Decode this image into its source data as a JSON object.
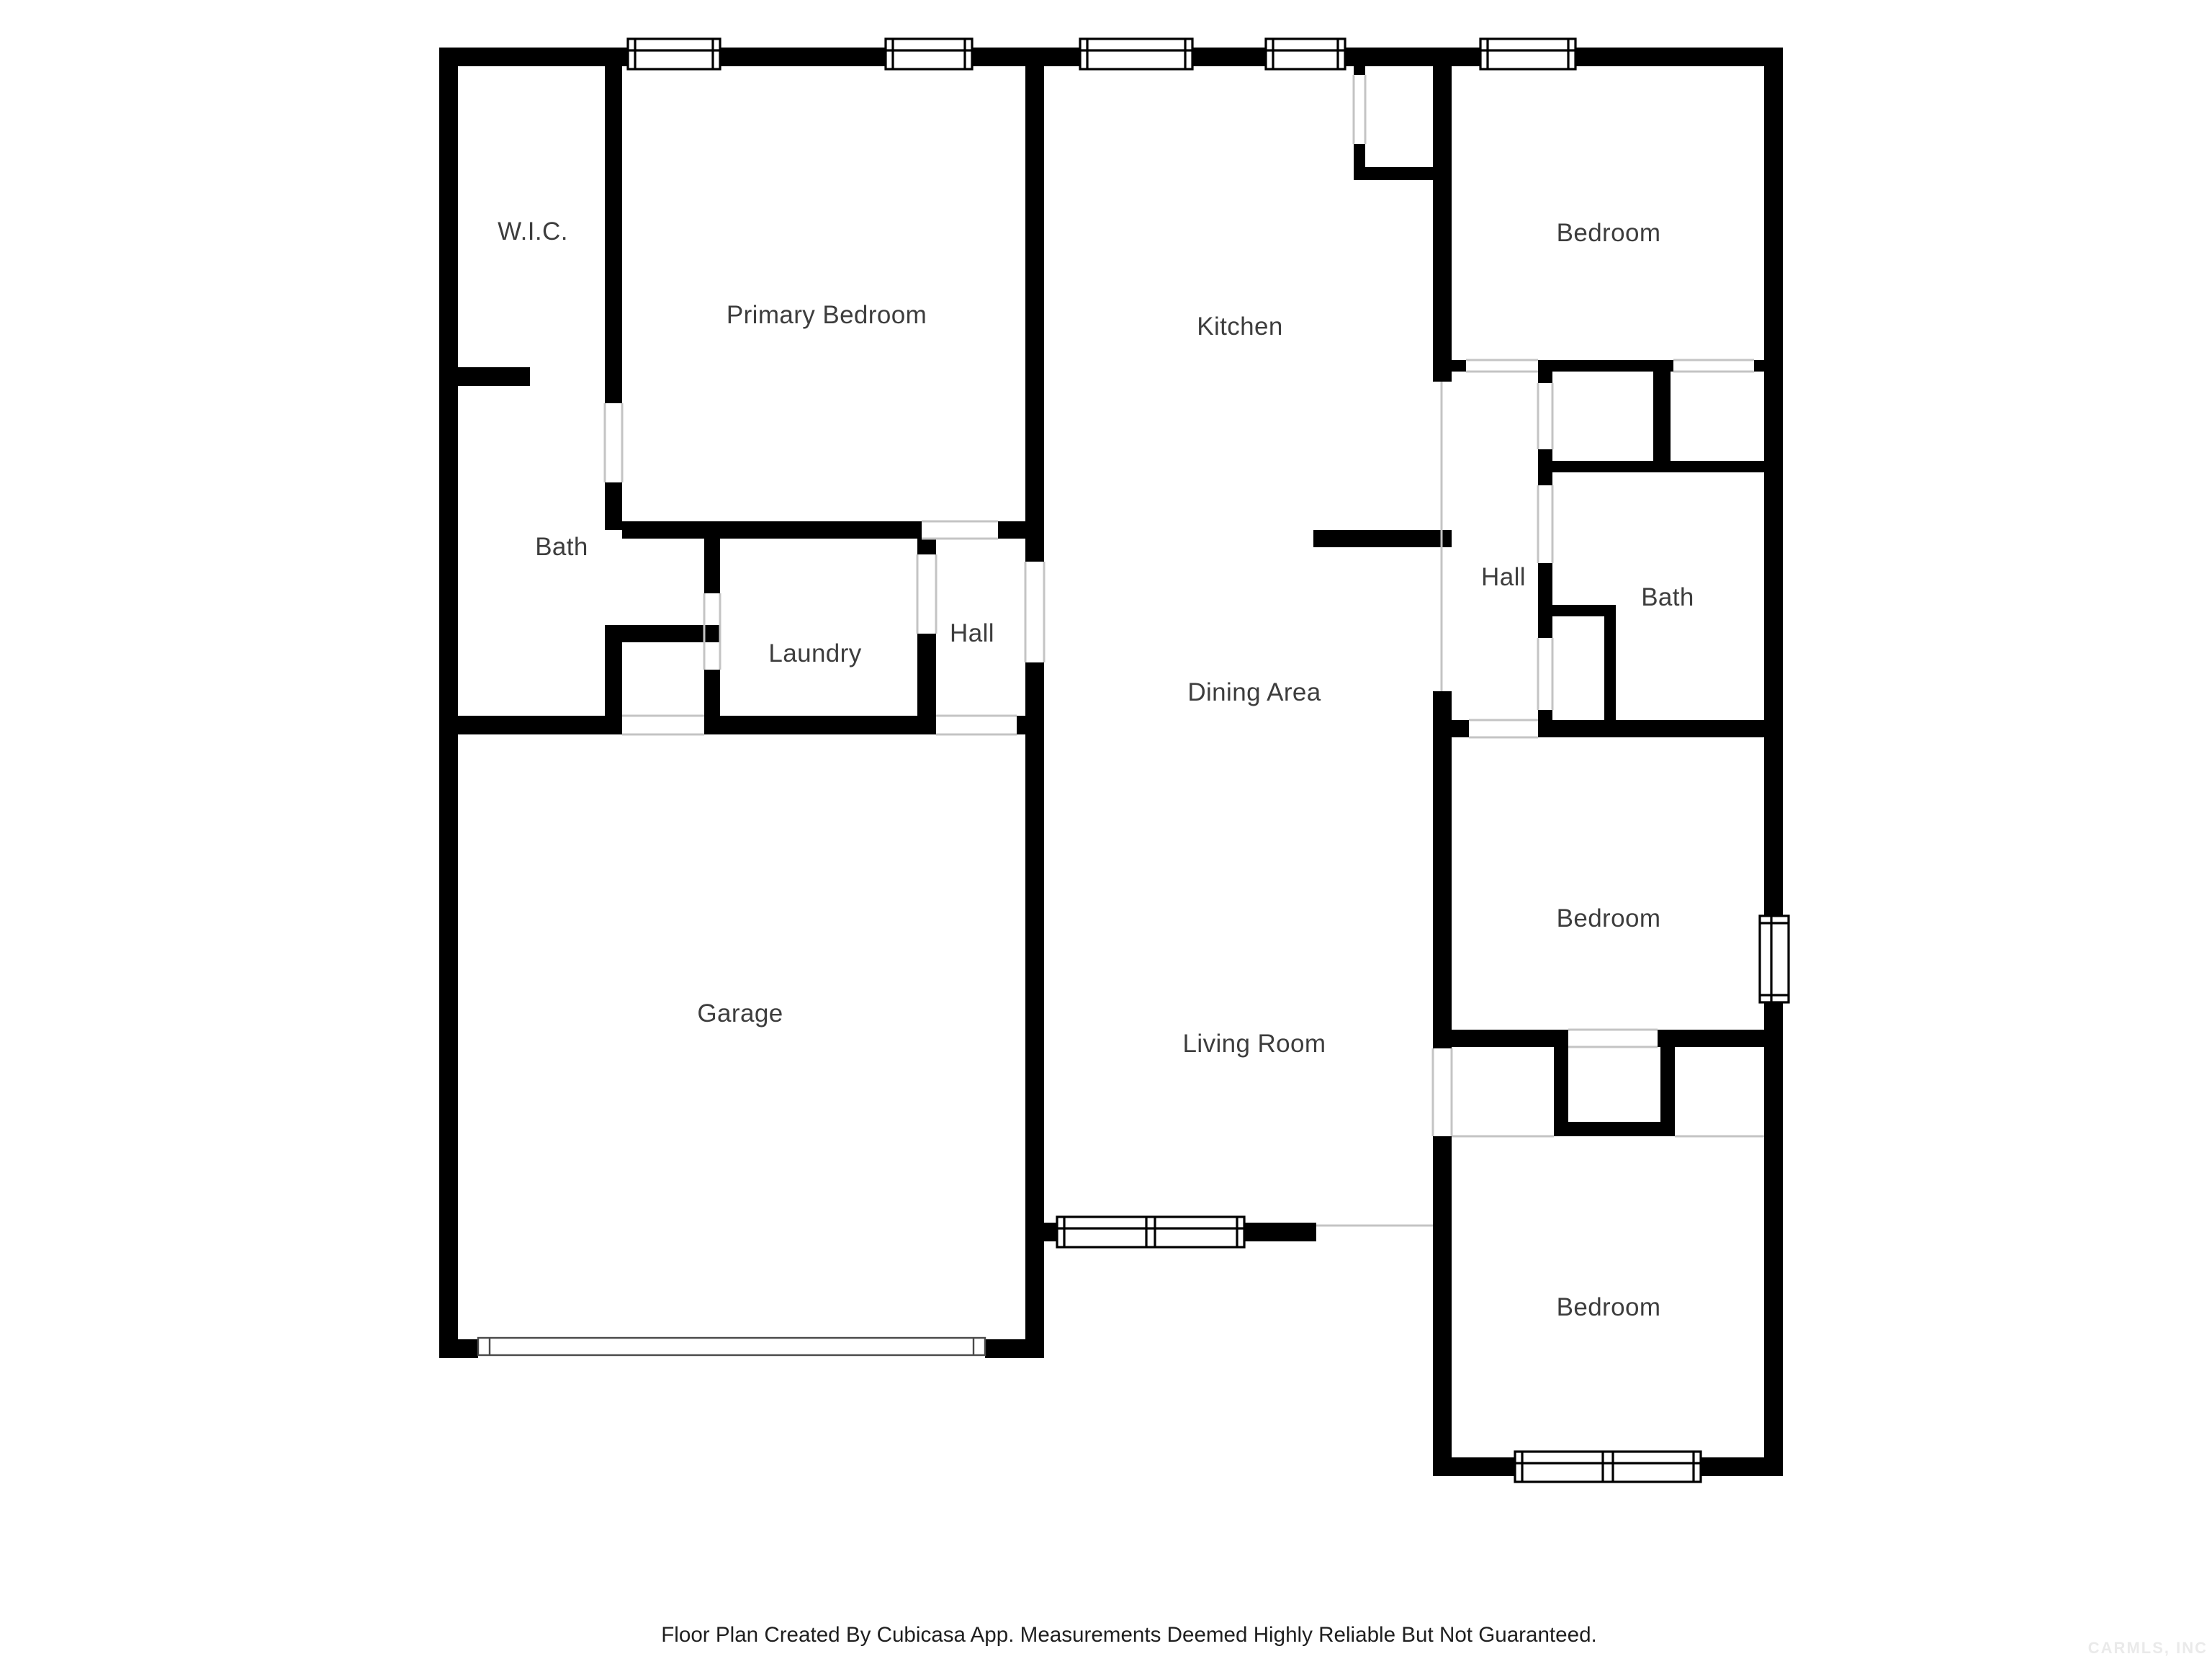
{
  "rooms": [
    {
      "id": "wic",
      "label": "W.I.C."
    },
    {
      "id": "primary-bedroom",
      "label": "Primary Bedroom"
    },
    {
      "id": "kitchen",
      "label": "Kitchen"
    },
    {
      "id": "bedroom-top-right",
      "label": "Bedroom"
    },
    {
      "id": "bath-left",
      "label": "Bath"
    },
    {
      "id": "laundry",
      "label": "Laundry"
    },
    {
      "id": "hall-left",
      "label": "Hall"
    },
    {
      "id": "hall-right",
      "label": "Hall"
    },
    {
      "id": "bath-right",
      "label": "Bath"
    },
    {
      "id": "dining-area",
      "label": "Dining Area"
    },
    {
      "id": "garage",
      "label": "Garage"
    },
    {
      "id": "living-room",
      "label": "Living Room"
    },
    {
      "id": "bedroom-middle-right",
      "label": "Bedroom"
    },
    {
      "id": "bedroom-bottom-right",
      "label": "Bedroom"
    }
  ],
  "footer": {
    "text": "Floor Plan Created By Cubicasa App. Measurements Deemed Highly Reliable But Not Guaranteed."
  },
  "watermark": {
    "text": "CARMLS, INC"
  },
  "colors": {
    "wall": "#000000",
    "background": "#ffffff",
    "label_text": "#3d3d3d",
    "footer_text": "#1f1f1f",
    "opening_line": "#c4c4c4",
    "watermark_text": "#eaeaea"
  }
}
